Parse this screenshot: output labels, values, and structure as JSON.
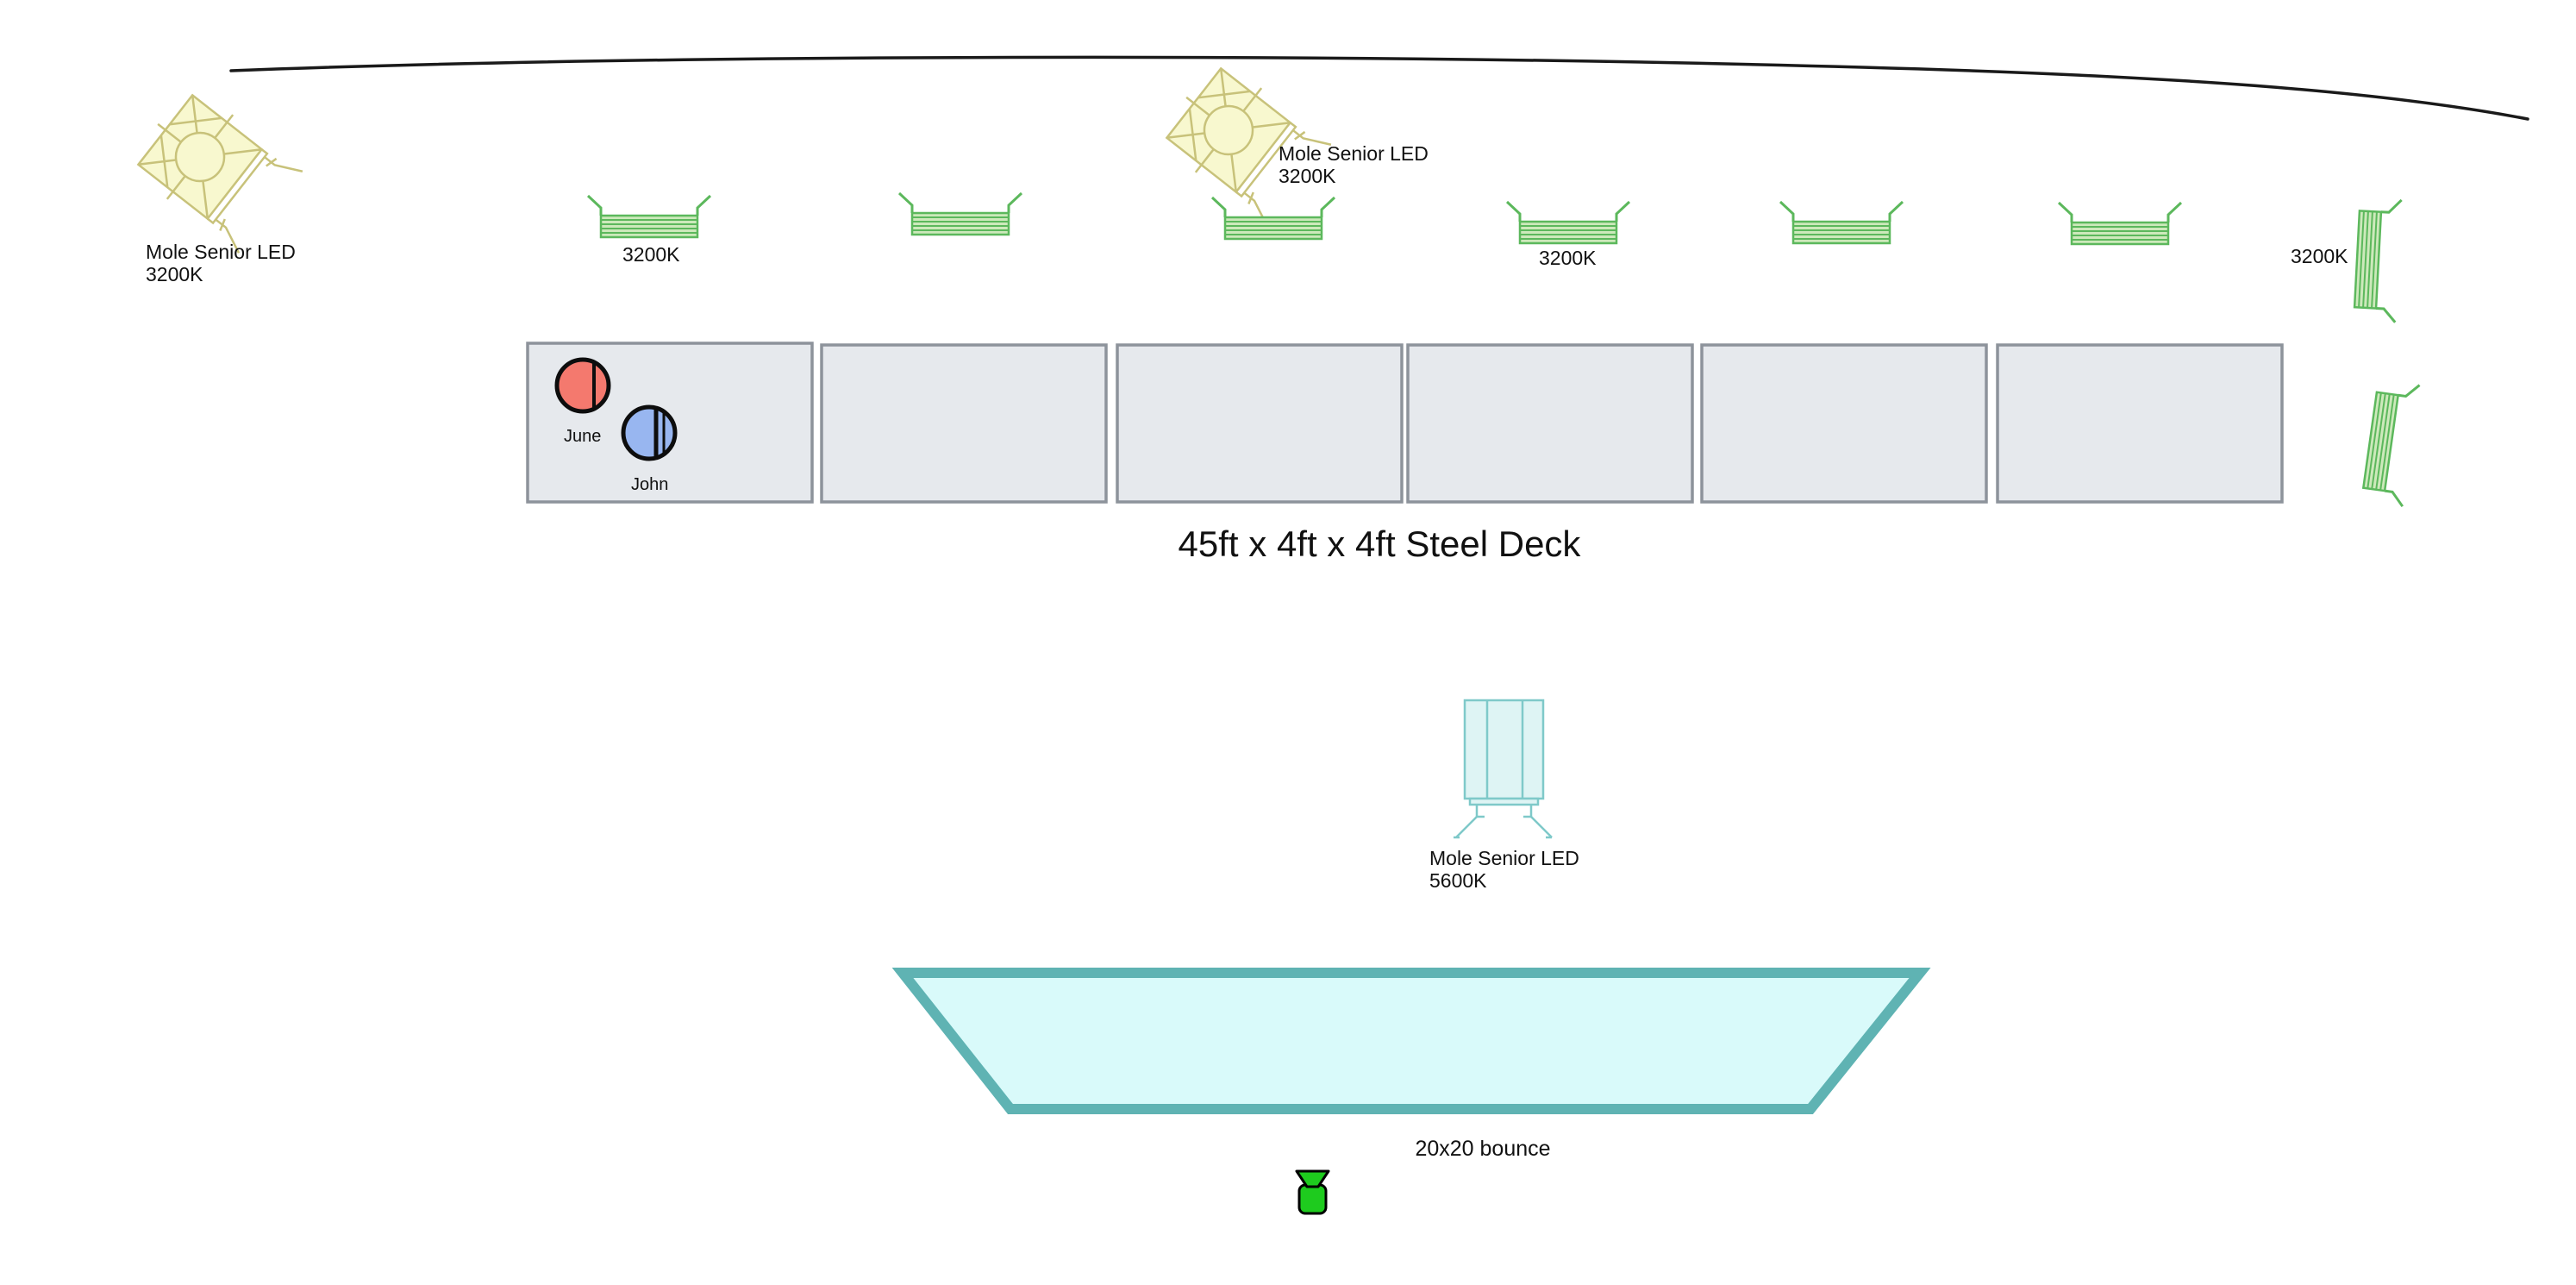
{
  "canvas": {
    "background": "#ffffff",
    "wall_color": "#1a1a1a"
  },
  "lights": {
    "fresnel_left": {
      "label1": "Mole Senior LED",
      "label2": "3200K",
      "fill": "#f8f8cf",
      "stroke": "#c8c27a"
    },
    "fresnel_top": {
      "label1": "Mole Senior LED",
      "label2": "3200K",
      "fill": "#f8f8cf",
      "stroke": "#c8c27a"
    },
    "mole_5600": {
      "label1": "Mole Senior LED",
      "label2": "5600K",
      "fill": "#def4f4",
      "stroke": "#7fc9c9"
    },
    "panel_kelvin_left": "3200K",
    "panel_kelvin_mid": "3200K",
    "panel_kelvin_right": "3200K",
    "panel_stroke": "#5cb85c",
    "panel_fill": "#cde9bb"
  },
  "deck": {
    "label": "45ft x 4ft x 4ft Steel Deck",
    "panel_fill": "#e6e9ed",
    "panel_stroke": "#8d939b",
    "panel_count": "6"
  },
  "persons": {
    "june": {
      "name": "June",
      "fill": "#f4796e"
    },
    "john": {
      "name": "John",
      "fill": "#98b6f0"
    }
  },
  "bounce": {
    "label": "20x20 bounce",
    "fill": "#d9fafa",
    "stroke": "#5fb3b3"
  },
  "camera": {
    "fill": "#1ecb1e"
  }
}
